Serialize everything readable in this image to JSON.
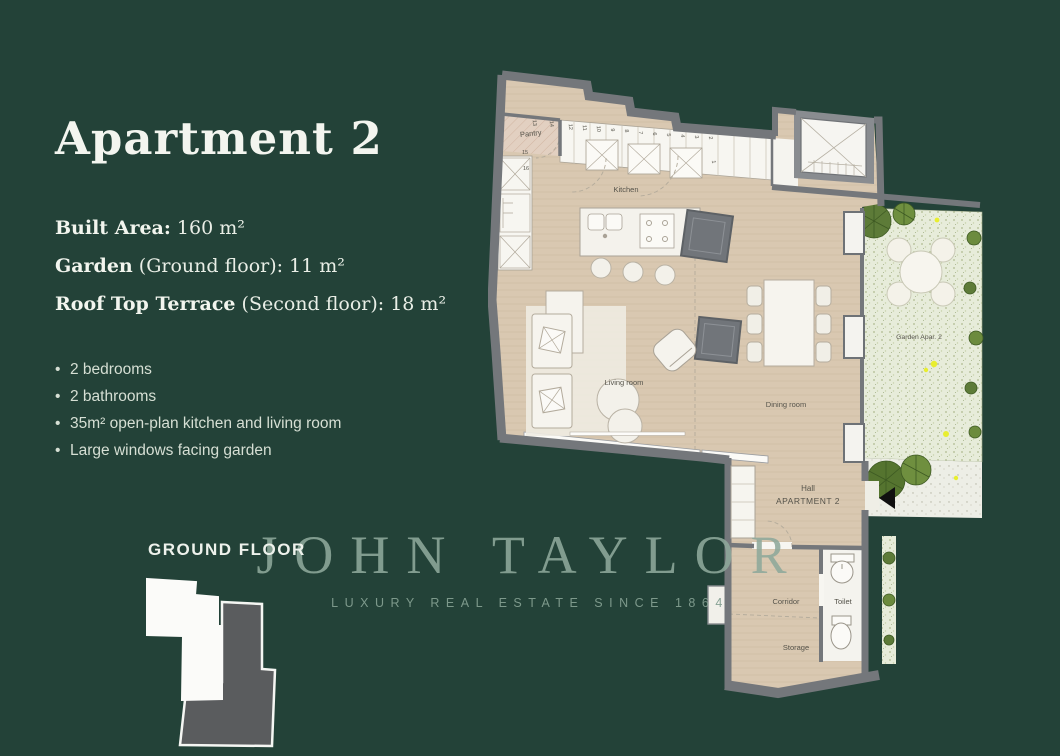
{
  "page": {
    "background": "#234238"
  },
  "left_panel": {
    "title": "Apartment 2",
    "specs": [
      {
        "label": "Built Area:",
        "value": " 160 m²"
      },
      {
        "label": "Garden",
        "value": " (Ground floor): 11 m²"
      },
      {
        "label": "Roof Top Terrace",
        "value": " (Second floor): 18 m²"
      }
    ],
    "features": [
      "2 bedrooms",
      "2 bathrooms",
      "35m² open-plan kitchen and living room",
      "Large windows facing garden"
    ],
    "floor_label": "GROUND FLOOR"
  },
  "watermark": {
    "brand": "JOHN TAYLOR",
    "tagline": "LUXURY REAL ESTATE SINCE 1864"
  },
  "floor_plan": {
    "rooms": {
      "pantry": "Pantry",
      "kitchen": "Kitchen",
      "living_room": "Living room",
      "dining_room": "Dining room",
      "garden": "Garden Apar. 2",
      "hall": "Hall",
      "hall_apartment": "APARTMENT 2",
      "corridor": "Corridor",
      "toilet": "Toilet",
      "storage": "Storage"
    },
    "cabinet_numbers": [
      "1",
      "2",
      "3",
      "4",
      "5",
      "6",
      "7",
      "8",
      "9",
      "10",
      "11",
      "12",
      "13",
      "14",
      "15",
      "16"
    ],
    "colors": {
      "background": "#234238",
      "floor": "#d9c8b1",
      "walls": "#74777b",
      "garden": "#e7ecda",
      "plants": "#5d7b38",
      "flowers": "#e8ee2f",
      "paper": "#f7f6f1",
      "pantry": "#e2d0c1"
    }
  }
}
